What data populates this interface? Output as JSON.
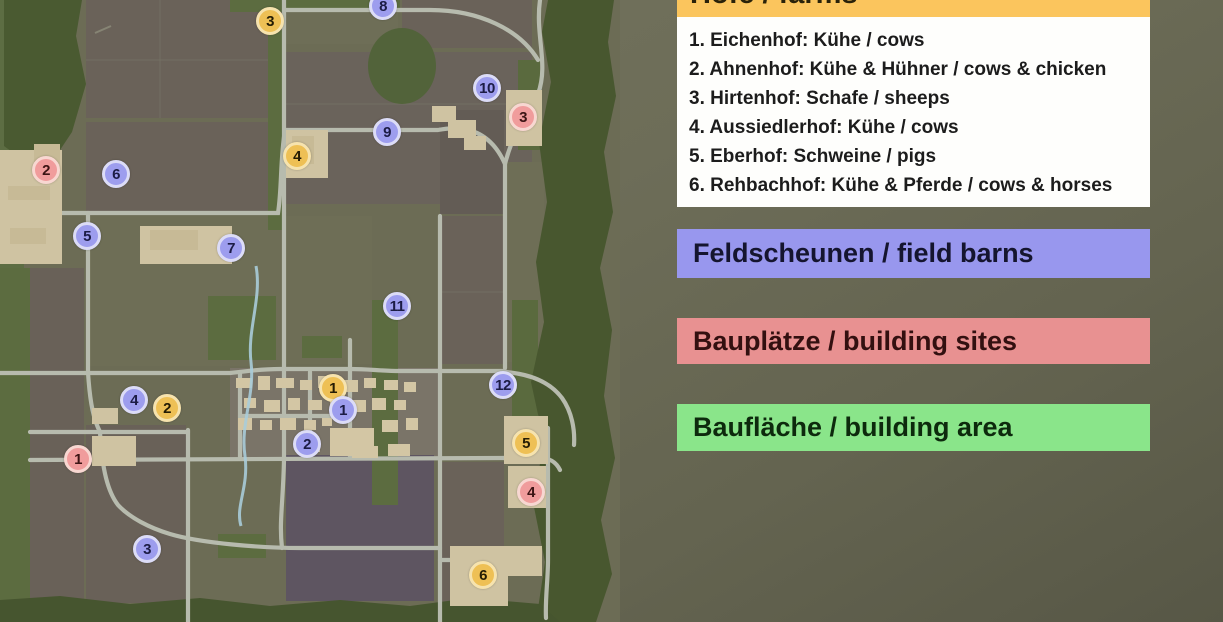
{
  "legend": {
    "farms": {
      "title": "Höfe / farms",
      "header_bg": "#fbc55d",
      "list_bg": "#fefefc",
      "items": [
        "1. Eichenhof: Kühe / cows",
        "2. Ahnenhof: Kühe & Hühner / cows & chicken",
        "3. Hirtenhof: Schafe / sheeps",
        "4. Aussiedlerhof: Kühe / cows",
        "5. Eberhof: Schweine / pigs",
        "6. Rehbachhof: Kühe & Pferde / cows & horses"
      ]
    },
    "field_barns": {
      "label": "Feldscheunen / field barns",
      "bg": "#9897ee"
    },
    "building_sites": {
      "label": "Bauplätze / building sites",
      "bg": "#e89191"
    },
    "building_area": {
      "label": "Baufläche / building area",
      "bg": "#8ae58a"
    }
  },
  "map": {
    "marker_styles": {
      "farm": {
        "bg": "#eec055",
        "border": "#f6e3ae",
        "text": "#241c04"
      },
      "barn": {
        "bg": "#9d9dee",
        "border": "#dcdcf7",
        "text": "#1c1c45"
      },
      "site": {
        "bg": "#f09c9c",
        "border": "#f8d7d1",
        "text": "#3c1414"
      }
    },
    "markers": [
      {
        "type": "farm",
        "num": "1",
        "x": 333,
        "y": 388
      },
      {
        "type": "farm",
        "num": "2",
        "x": 167,
        "y": 408
      },
      {
        "type": "farm",
        "num": "3",
        "x": 270,
        "y": 21
      },
      {
        "type": "farm",
        "num": "4",
        "x": 297,
        "y": 156
      },
      {
        "type": "farm",
        "num": "5",
        "x": 526,
        "y": 443
      },
      {
        "type": "farm",
        "num": "6",
        "x": 483,
        "y": 575
      },
      {
        "type": "barn",
        "num": "1",
        "x": 343,
        "y": 410
      },
      {
        "type": "barn",
        "num": "2",
        "x": 307,
        "y": 444
      },
      {
        "type": "barn",
        "num": "3",
        "x": 147,
        "y": 549
      },
      {
        "type": "barn",
        "num": "4",
        "x": 134,
        "y": 400
      },
      {
        "type": "barn",
        "num": "5",
        "x": 87,
        "y": 236
      },
      {
        "type": "barn",
        "num": "6",
        "x": 116,
        "y": 174
      },
      {
        "type": "barn",
        "num": "7",
        "x": 231,
        "y": 248
      },
      {
        "type": "barn",
        "num": "8",
        "x": 383,
        "y": 6
      },
      {
        "type": "barn",
        "num": "9",
        "x": 387,
        "y": 132
      },
      {
        "type": "barn",
        "num": "10",
        "x": 487,
        "y": 88
      },
      {
        "type": "barn",
        "num": "11",
        "x": 397,
        "y": 306
      },
      {
        "type": "barn",
        "num": "12",
        "x": 503,
        "y": 385
      },
      {
        "type": "site",
        "num": "1",
        "x": 78,
        "y": 459
      },
      {
        "type": "site",
        "num": "2",
        "x": 46,
        "y": 170
      },
      {
        "type": "site",
        "num": "3",
        "x": 523,
        "y": 117
      },
      {
        "type": "site",
        "num": "4",
        "x": 531,
        "y": 492
      }
    ]
  }
}
